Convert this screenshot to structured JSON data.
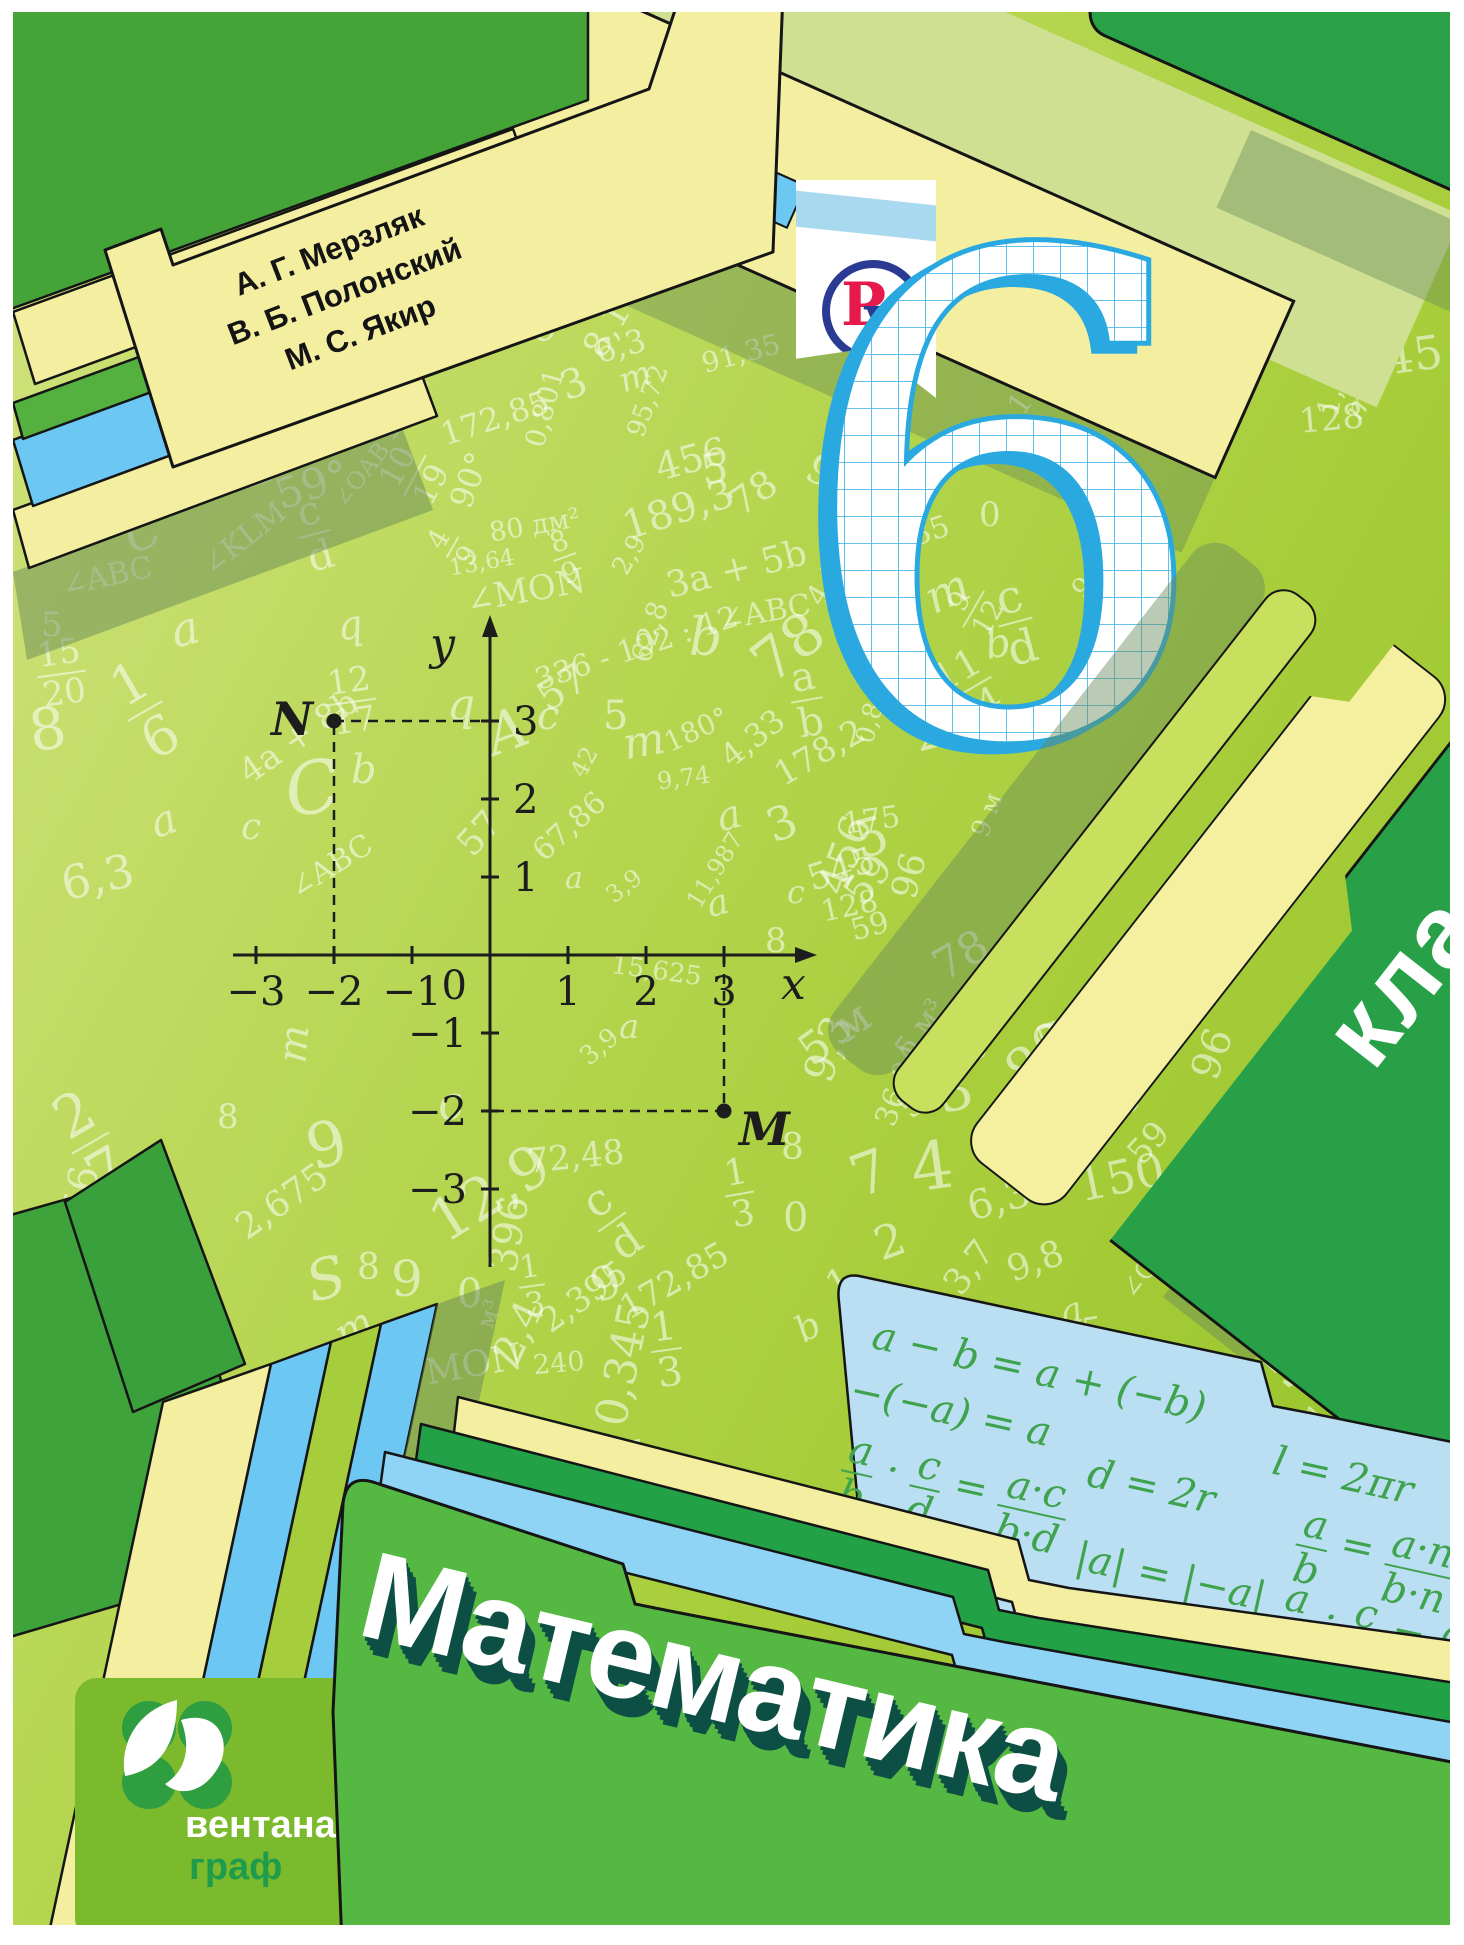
{
  "cover": {
    "authors": [
      "А. Г. Мерзляк",
      "В. Б. Полонский",
      "М. С. Якир"
    ],
    "publisher_logo": {
      "letter_p": "Р",
      "letter_u": "у"
    },
    "grade_number": "6",
    "grade_word": "класс",
    "title": "Математика",
    "publisher": {
      "line1": "вентана",
      "line2": "граф"
    }
  },
  "palette": {
    "background_green": "#a7cd3a",
    "folder_green": "#55b843",
    "tab_yellow": "#f4efa0",
    "tab_blue": "#6cc8f2",
    "tab_dark_green": "#23a147",
    "klass_tab_green": "#28a048",
    "cyan_panel": "#badef2",
    "formula_green": "#3fa34d",
    "grid_cyan": "#2aa9e1",
    "logo_blue": "#2b3a92",
    "logo_red": "#e51a4b",
    "ventana_green": "#7aba2c",
    "title_shadow": "#0d4f44"
  },
  "plane": {
    "x_label": "x",
    "y_label": "y",
    "origin": "0",
    "x_ticks": [
      "−3",
      "−2",
      "−1",
      "1",
      "2",
      "3"
    ],
    "y_ticks": [
      "3",
      "2",
      "1",
      "−1",
      "−2",
      "−3"
    ],
    "points": [
      {
        "label": "N",
        "x": -2,
        "y": 3
      },
      {
        "label": "M",
        "x": 3,
        "y": -2
      }
    ]
  },
  "formulas": [
    {
      "t": "a − b = a + (−b)",
      "x": 12,
      "y": 8
    },
    {
      "t": "l = 2πr",
      "x": 430,
      "y": 44
    },
    {
      "t": "−(−a) = a",
      "x": 2,
      "y": 66
    },
    {
      "t": "d = 2r",
      "x": 252,
      "y": 96
    },
    {
      "t": "{a|b} · {c|d} = {a·c|b·d}",
      "x": 10,
      "y": 126
    },
    {
      "t": "|a| = |−a|",
      "x": 258,
      "y": 180
    },
    {
      "t": "{a|b} = {a·n|b·n}",
      "x": 470,
      "y": 100
    },
    {
      "t": "{a|b} : {c|d} = {a·d|b·c}",
      "x": 468,
      "y": 176
    }
  ],
  "background_numbers": [
    {
      "t": "m",
      "x": 630,
      "y": 16,
      "s": 30,
      "r": -25,
      "i": 1
    },
    {
      "t": "1,50",
      "x": 548,
      "y": 92,
      "s": 28,
      "r": -35
    },
    {
      "t": "396",
      "x": 592,
      "y": 124,
      "s": 36,
      "r": -28
    },
    {
      "t": "100",
      "x": 528,
      "y": 166,
      "s": 40,
      "r": -30
    },
    {
      "t": "545",
      "x": 628,
      "y": 168,
      "s": 44,
      "r": -30
    },
    {
      "t": "128",
      "x": 598,
      "y": 240,
      "s": 40,
      "r": -35
    },
    {
      "t": "8,1",
      "x": 566,
      "y": 300,
      "s": 36,
      "r": -60
    },
    {
      "t": "6",
      "x": 516,
      "y": 296,
      "s": 40,
      "r": -25
    },
    {
      "t": "3",
      "x": 548,
      "y": 352,
      "s": 40,
      "r": -20
    },
    {
      "t": "59",
      "x": 900,
      "y": 172,
      "s": 42,
      "r": -55
    },
    {
      "t": "15,625",
      "x": 952,
      "y": 208,
      "s": 28,
      "r": -55
    },
    {
      "t": "S",
      "x": 936,
      "y": 226,
      "s": 62,
      "r": -20,
      "i": 1
    },
    {
      "t": "175",
      "x": 1078,
      "y": 196,
      "s": 44,
      "r": -15
    },
    {
      "t": "a",
      "x": 828,
      "y": 222,
      "s": 46,
      "r": -15,
      "i": 1
    },
    {
      "t": "c",
      "x": 870,
      "y": 236,
      "s": 40,
      "r": -25,
      "i": 1
    },
    {
      "t": "36,04",
      "x": 898,
      "y": 244,
      "s": 26,
      "r": -80
    },
    {
      "t": "4,33",
      "x": 982,
      "y": 204,
      "s": 28,
      "r": -72
    },
    {
      "t": "178,2",
      "x": 1118,
      "y": 242,
      "s": 30,
      "r": -12
    },
    {
      "t": "p",
      "x": 1178,
      "y": 225,
      "s": 42,
      "r": 8,
      "i": 1
    },
    {
      "t": "58",
      "x": 942,
      "y": 292,
      "s": 34,
      "r": -30
    },
    {
      "t": "8",
      "x": 1004,
      "y": 298,
      "s": 34,
      "r": -25
    },
    {
      "t": "172,85",
      "x": 980,
      "y": 342,
      "s": 30,
      "r": -55
    },
    {
      "t": "545",
      "x": 1342,
      "y": 322,
      "s": 46,
      "r": -8
    },
    {
      "t": "1,8",
      "x": 1296,
      "y": 366,
      "s": 30,
      "r": -80
    },
    {
      "t": "128",
      "x": 1286,
      "y": 390,
      "s": 34,
      "r": -5
    },
    {
      "t": "m",
      "x": 1332,
      "y": 378,
      "s": 30,
      "r": -60,
      "i": 1
    },
    {
      "t": "9,8",
      "x": 792,
      "y": 448,
      "s": 42,
      "r": 30
    },
    {
      "t": "4,5",
      "x": 790,
      "y": 556,
      "s": 30,
      "r": -60
    },
    {
      "t": "91,35",
      "x": 852,
      "y": 512,
      "s": 30,
      "r": -18
    },
    {
      "t": "3,7",
      "x": 830,
      "y": 586,
      "s": 46,
      "r": -12
    },
    {
      "t": "m",
      "x": 912,
      "y": 556,
      "s": 46,
      "r": -25,
      "i": 1
    },
    {
      "t": "0",
      "x": 966,
      "y": 486,
      "s": 34
    },
    {
      "t": "b",
      "x": 972,
      "y": 612,
      "s": 40,
      "r": -10,
      "i": 1
    },
    {
      "t": "231",
      "x": 900,
      "y": 690,
      "s": 46,
      "r": -15
    },
    {
      "t": "5",
      "x": 842,
      "y": 800,
      "s": 52,
      "r": -15
    },
    {
      "t": "456",
      "x": 792,
      "y": 822,
      "s": 42,
      "r": -70
    },
    {
      "t": "78",
      "x": 920,
      "y": 922,
      "s": 44,
      "r": -30
    },
    {
      "t": "5 м³",
      "x": 876,
      "y": 1002,
      "s": 30,
      "r": -55
    },
    {
      "t": "9,3",
      "x": 782,
      "y": 1016,
      "s": 42,
      "r": -70
    },
    {
      "t": "9 м",
      "x": 952,
      "y": 790,
      "s": 26,
      "r": -70
    },
    {
      "t": "{9|12}",
      "x": 940,
      "y": 566,
      "s": 28,
      "r": -60
    },
    {
      "t": "{11|14}",
      "x": 928,
      "y": 636,
      "s": 38,
      "r": -30
    },
    {
      "t": "{c|d}",
      "x": 985,
      "y": 560,
      "s": 46,
      "r": -15
    },
    {
      "t": "91,35",
      "x": 1052,
      "y": 540,
      "s": 28,
      "r": -45
    },
    {
      "t": "189,3",
      "x": 608,
      "y": 478,
      "s": 40,
      "r": -18
    },
    {
      "t": "456",
      "x": 642,
      "y": 428,
      "s": 38,
      "r": -15
    },
    {
      "t": "5",
      "x": 688,
      "y": 436,
      "s": 42,
      "r": -10
    },
    {
      "t": "78",
      "x": 716,
      "y": 462,
      "s": 38,
      "r": -35
    },
    {
      "t": "91,35",
      "x": 688,
      "y": 328,
      "s": 28,
      "r": -15
    },
    {
      "t": "6,3",
      "x": 582,
      "y": 318,
      "s": 32,
      "r": -15
    },
    {
      "t": "95,72",
      "x": 598,
      "y": 376,
      "s": 26,
      "r": -70
    },
    {
      "t": "m",
      "x": 606,
      "y": 348,
      "s": 34,
      "r": -20,
      "i": 1
    },
    {
      "t": "172,85",
      "x": 426,
      "y": 390,
      "s": 32,
      "r": -18
    },
    {
      "t": "0,801",
      "x": 492,
      "y": 382,
      "s": 28,
      "r": -75
    },
    {
      "t": "{10|19}",
      "x": 378,
      "y": 428,
      "s": 32,
      "r": -62
    },
    {
      "t": "90°",
      "x": 428,
      "y": 452,
      "s": 32,
      "r": -70
    },
    {
      "t": "59°",
      "x": 262,
      "y": 452,
      "s": 42,
      "r": -18
    },
    {
      "t": "∠OAB = 90°",
      "x": 296,
      "y": 420,
      "s": 24,
      "r": -52
    },
    {
      "t": "{8|9}",
      "x": 540,
      "y": 514,
      "s": 28,
      "r": -20
    },
    {
      "t": "{4|9}",
      "x": 428,
      "y": 504,
      "s": 28,
      "r": -60
    },
    {
      "t": "80 дм²",
      "x": 476,
      "y": 500,
      "s": 27,
      "r": -10
    },
    {
      "t": "1",
      "x": 222,
      "y": 420,
      "s": 64,
      "r": -18
    },
    {
      "t": "{c|d}",
      "x": 286,
      "y": 478,
      "s": 40,
      "r": -15
    },
    {
      "t": "∠KLM",
      "x": 182,
      "y": 512,
      "s": 30,
      "r": -38
    },
    {
      "t": "∠ABC",
      "x": 48,
      "y": 550,
      "s": 30,
      "r": -12
    },
    {
      "t": "C",
      "x": 112,
      "y": 498,
      "s": 46,
      "r": -20,
      "i": 1
    },
    {
      "t": "c",
      "x": 28,
      "y": 505,
      "s": 36,
      "i": 1
    },
    {
      "t": "13,64",
      "x": 436,
      "y": 540,
      "s": 23,
      "r": -10
    },
    {
      "t": "2,9",
      "x": 596,
      "y": 530,
      "s": 26,
      "r": -60
    },
    {
      "t": "∠MON",
      "x": 452,
      "y": 562,
      "s": 34,
      "r": -10
    },
    {
      "t": "3a + 5b",
      "x": 652,
      "y": 540,
      "s": 36,
      "r": -14
    },
    {
      "t": "∠ABC",
      "x": 706,
      "y": 586,
      "s": 30,
      "r": -10
    },
    {
      "t": "62,8",
      "x": 606,
      "y": 606,
      "s": 28,
      "r": -72
    },
    {
      "t": "336 - 192 : 12",
      "x": 518,
      "y": 622,
      "s": 30,
      "r": -18
    },
    {
      "t": "78",
      "x": 738,
      "y": 606,
      "s": 58,
      "r": -38
    },
    {
      "t": "b",
      "x": 676,
      "y": 600,
      "s": 52,
      "i": 1
    },
    {
      "t": "57",
      "x": 524,
      "y": 656,
      "s": 40,
      "r": -32
    },
    {
      "t": "5",
      "x": 28,
      "y": 596,
      "s": 34
    },
    {
      "t": "{15|20}",
      "x": 24,
      "y": 624,
      "s": 34,
      "r": -8
    },
    {
      "t": "a",
      "x": 158,
      "y": 594,
      "s": 46,
      "r": -15,
      "i": 1
    },
    {
      "t": "{1|6}",
      "x": 112,
      "y": 640,
      "s": 54,
      "r": -30
    },
    {
      "t": "q",
      "x": 324,
      "y": 594,
      "s": 40,
      "r": -10,
      "i": 1
    },
    {
      "t": "{12|17}",
      "x": 314,
      "y": 652,
      "s": 34,
      "r": -8
    },
    {
      "t": "q",
      "x": 434,
      "y": 672,
      "s": 44,
      "i": 1
    },
    {
      "t": "A",
      "x": 474,
      "y": 692,
      "s": 56,
      "r": -20,
      "i": 1
    },
    {
      "t": "c",
      "x": 524,
      "y": 684,
      "s": 40,
      "i": 1
    },
    {
      "t": "5",
      "x": 590,
      "y": 684,
      "s": 40
    },
    {
      "t": "m",
      "x": 610,
      "y": 708,
      "s": 44,
      "r": -10,
      "i": 1
    },
    {
      "t": "180°",
      "x": 650,
      "y": 704,
      "s": 28,
      "r": -25
    },
    {
      "t": "4,33",
      "x": 704,
      "y": 710,
      "s": 32,
      "r": -38
    },
    {
      "t": "178,2",
      "x": 758,
      "y": 724,
      "s": 34,
      "r": -30
    },
    {
      "t": "{a|b}",
      "x": 778,
      "y": 644,
      "s": 40,
      "r": -10
    },
    {
      "t": "0,801",
      "x": 824,
      "y": 682,
      "s": 26,
      "r": -75
    },
    {
      "t": "4a + 8b",
      "x": 218,
      "y": 708,
      "s": 34,
      "r": -35
    },
    {
      "t": "C",
      "x": 272,
      "y": 740,
      "s": 72,
      "r": -10,
      "i": 1
    },
    {
      "t": "b",
      "x": 338,
      "y": 738,
      "s": 40,
      "i": 1
    },
    {
      "t": "42",
      "x": 556,
      "y": 738,
      "s": 24,
      "r": -62
    },
    {
      "t": "9,74",
      "x": 644,
      "y": 754,
      "s": 24,
      "r": -8
    },
    {
      "t": "a",
      "x": 704,
      "y": 784,
      "s": 40,
      "r": -15,
      "i": 1
    },
    {
      "t": "3",
      "x": 754,
      "y": 788,
      "s": 46,
      "r": -20
    },
    {
      "t": "175",
      "x": 830,
      "y": 794,
      "s": 30,
      "r": -8
    },
    {
      "t": "57",
      "x": 444,
      "y": 804,
      "s": 36,
      "r": -48
    },
    {
      "t": "c",
      "x": 228,
      "y": 798,
      "s": 36,
      "i": 1
    },
    {
      "t": "a",
      "x": 138,
      "y": 788,
      "s": 42,
      "r": -20,
      "i": 1
    },
    {
      "t": "6,3",
      "x": 48,
      "y": 842,
      "s": 46,
      "r": -12
    },
    {
      "t": "8",
      "x": 16,
      "y": 688,
      "s": 58,
      "r": -8
    },
    {
      "t": "∠ABC",
      "x": 272,
      "y": 840,
      "s": 30,
      "r": -32
    },
    {
      "t": "67,86",
      "x": 514,
      "y": 800,
      "s": 30,
      "r": -42
    },
    {
      "t": "a",
      "x": 552,
      "y": 852,
      "s": 30,
      "i": 1
    },
    {
      "t": "3,9",
      "x": 592,
      "y": 862,
      "s": 24,
      "r": -38
    },
    {
      "t": "11,987",
      "x": 660,
      "y": 846,
      "s": 24,
      "r": -58
    },
    {
      "t": "a",
      "x": 694,
      "y": 874,
      "s": 36,
      "r": -15,
      "i": 1
    },
    {
      "t": "c",
      "x": 774,
      "y": 864,
      "s": 32,
      "i": 1
    },
    {
      "t": "59",
      "x": 830,
      "y": 848,
      "s": 40,
      "r": -52
    },
    {
      "t": "96",
      "x": 874,
      "y": 846,
      "s": 36,
      "r": -75
    },
    {
      "t": "545",
      "x": 794,
      "y": 840,
      "s": 36,
      "r": -18
    },
    {
      "t": "128",
      "x": 808,
      "y": 880,
      "s": 30,
      "r": -12
    },
    {
      "t": "59",
      "x": 838,
      "y": 900,
      "s": 30,
      "r": -15
    },
    {
      "t": "8",
      "x": 752,
      "y": 912,
      "s": 34
    },
    {
      "t": "12,9",
      "x": 412,
      "y": 1152,
      "s": 58,
      "r": -32
    },
    {
      "t": "72,48",
      "x": 514,
      "y": 1128,
      "s": 34,
      "r": -6
    },
    {
      "t": "c",
      "x": 424,
      "y": 1068,
      "s": 46,
      "r": -10,
      "i": 1
    },
    {
      "t": "m",
      "x": 262,
      "y": 1012,
      "s": 40,
      "r": -85,
      "i": 1
    },
    {
      "t": "{2|7}",
      "x": 56,
      "y": 1068,
      "s": 58,
      "r": -30
    },
    {
      "t": "8",
      "x": 204,
      "y": 1088,
      "s": 34
    },
    {
      "t": "9",
      "x": 294,
      "y": 1102,
      "s": 62,
      "r": -15
    },
    {
      "t": "456",
      "x": 28,
      "y": 1172,
      "s": 40,
      "r": -80
    },
    {
      "t": "2,675",
      "x": 218,
      "y": 1172,
      "s": 36,
      "r": -35
    },
    {
      "t": "172,85",
      "x": 112,
      "y": 1292,
      "s": 30,
      "r": -70
    },
    {
      "t": "{a|d}",
      "x": 78,
      "y": 1226,
      "s": 50,
      "r": -15
    },
    {
      "t": "n",
      "x": 22,
      "y": 1282,
      "s": 46,
      "i": 1
    },
    {
      "t": "m",
      "x": 322,
      "y": 1296,
      "s": 40,
      "r": -30,
      "i": 1
    },
    {
      "t": "396",
      "x": 458,
      "y": 1202,
      "s": 40,
      "r": -80
    },
    {
      "t": "м³",
      "x": 462,
      "y": 1290,
      "s": 24,
      "r": -70
    },
    {
      "t": "{c|d}",
      "x": 582,
      "y": 1162,
      "s": 44,
      "r": -35
    },
    {
      "t": "2,395",
      "x": 522,
      "y": 1268,
      "s": 34,
      "r": -35
    },
    {
      "t": "172,85",
      "x": 602,
      "y": 1252,
      "s": 34,
      "r": -30
    },
    {
      "t": "{1|3}",
      "x": 638,
      "y": 1294,
      "s": 40,
      "r": -8
    },
    {
      "t": "∠MON",
      "x": 382,
      "y": 1338,
      "s": 36,
      "r": -10
    },
    {
      "t": "15,625",
      "x": 598,
      "y": 946,
      "s": 26,
      "r": 8
    },
    {
      "t": "a",
      "x": 606,
      "y": 998,
      "s": 34,
      "i": 1
    },
    {
      "t": "{1|3}",
      "x": 712,
      "y": 1142,
      "s": 36,
      "r": -10
    },
    {
      "t": "8",
      "x": 768,
      "y": 1118,
      "s": 36
    },
    {
      "t": "0",
      "x": 770,
      "y": 1186,
      "s": 40
    },
    {
      "t": "3,9",
      "x": 566,
      "y": 1022,
      "s": 26,
      "r": -40
    },
    {
      "t": "5 м",
      "x": 784,
      "y": 1000,
      "s": 44,
      "r": -35
    },
    {
      "t": "36,04",
      "x": 844,
      "y": 1058,
      "s": 30,
      "r": -70
    },
    {
      "t": "59",
      "x": 884,
      "y": 1068,
      "s": 34,
      "r": -48
    },
    {
      "t": "3",
      "x": 924,
      "y": 1052,
      "s": 56,
      "r": -15
    },
    {
      "t": "6",
      "x": 950,
      "y": 1014,
      "s": 40
    },
    {
      "t": "80",
      "x": 992,
      "y": 1016,
      "s": 56,
      "r": -42
    },
    {
      "t": "8,1",
      "x": 1010,
      "y": 1080,
      "s": 36,
      "r": -60
    },
    {
      "t": "545",
      "x": 1022,
      "y": 994,
      "s": 50,
      "r": -20
    },
    {
      "t": "96",
      "x": 1174,
      "y": 1022,
      "s": 40,
      "r": -70
    },
    {
      "t": "128",
      "x": 1054,
      "y": 1084,
      "s": 40,
      "r": -38
    },
    {
      "t": "59",
      "x": 1114,
      "y": 1114,
      "s": 34,
      "r": -48
    },
    {
      "t": "7",
      "x": 838,
      "y": 1132,
      "s": 58,
      "r": -20
    },
    {
      "t": "4",
      "x": 898,
      "y": 1122,
      "s": 66,
      "r": -8
    },
    {
      "t": "6,3",
      "x": 954,
      "y": 1168,
      "s": 40,
      "r": -15
    },
    {
      "t": "m",
      "x": 988,
      "y": 1138,
      "s": 34,
      "r": -30,
      "i": 1
    },
    {
      "t": "150",
      "x": 1064,
      "y": 1142,
      "s": 46,
      "r": -12
    },
    {
      "t": "67,86",
      "x": 1180,
      "y": 1190,
      "s": 48,
      "r": -38
    },
    {
      "t": "2",
      "x": 862,
      "y": 1206,
      "s": 46,
      "r": -20
    },
    {
      "t": "3,7",
      "x": 928,
      "y": 1238,
      "s": 36,
      "r": -52
    },
    {
      "t": "9,8",
      "x": 994,
      "y": 1232,
      "s": 36,
      "r": -20
    },
    {
      "t": "1",
      "x": 814,
      "y": 1252,
      "s": 40,
      "r": -30
    },
    {
      "t": "0",
      "x": 872,
      "y": 1278,
      "s": 40,
      "r": -15
    },
    {
      "t": "∠CDE",
      "x": 1098,
      "y": 1238,
      "s": 26,
      "r": -52
    },
    {
      "t": "a",
      "x": 1048,
      "y": 1282,
      "s": 36,
      "r": -15,
      "i": 1
    },
    {
      "t": "b",
      "x": 784,
      "y": 1298,
      "s": 36,
      "r": -30,
      "i": 1
    },
    {
      "t": "дм",
      "x": 838,
      "y": 1326,
      "s": 26,
      "r": -28
    },
    {
      "t": "91,35",
      "x": 994,
      "y": 1308,
      "s": 34,
      "r": -10
    },
    {
      "t": "36,04",
      "x": 1254,
      "y": 1294,
      "s": 34,
      "r": -18
    },
    {
      "t": "240",
      "x": 1368,
      "y": 1312,
      "s": 30,
      "r": -48
    },
    {
      "t": "75",
      "x": 1222,
      "y": 1338,
      "s": 58,
      "r": -48
    },
    {
      "t": "396",
      "x": 1404,
      "y": 1350,
      "s": 28,
      "r": -10
    },
    {
      "t": "15,625",
      "x": 1344,
      "y": 1246,
      "s": 24,
      "r": -82
    },
    {
      "t": "{13|17}",
      "x": 1302,
      "y": 1378,
      "s": 26,
      "r": -48
    },
    {
      "t": "15,625",
      "x": 1356,
      "y": 1346,
      "s": 26,
      "r": 178
    },
    {
      "t": "a",
      "x": 1396,
      "y": 1322,
      "s": 30,
      "i": 1
    },
    {
      "t": "2,4",
      "x": 474,
      "y": 1300,
      "s": 40,
      "r": -65
    },
    {
      "t": "240",
      "x": 520,
      "y": 1338,
      "s": 27,
      "r": -5
    },
    {
      "t": "0",
      "x": 444,
      "y": 1262,
      "s": 40
    },
    {
      "t": "{1|3}",
      "x": 506,
      "y": 1238,
      "s": 32,
      "r": -8
    },
    {
      "t": "9",
      "x": 578,
      "y": 1248,
      "s": 46,
      "r": -20
    },
    {
      "t": "8",
      "x": 344,
      "y": 1238,
      "s": 36
    },
    {
      "t": "9",
      "x": 378,
      "y": 1242,
      "s": 50
    },
    {
      "t": "S",
      "x": 294,
      "y": 1240,
      "s": 56,
      "r": -15,
      "i": 1
    },
    {
      "t": "0,345",
      "x": 548,
      "y": 1330,
      "s": 44,
      "r": -78
    },
    {
      "t": "a",
      "x": 600,
      "y": 1412,
      "s": 58,
      "r": -20,
      "i": 1
    }
  ]
}
